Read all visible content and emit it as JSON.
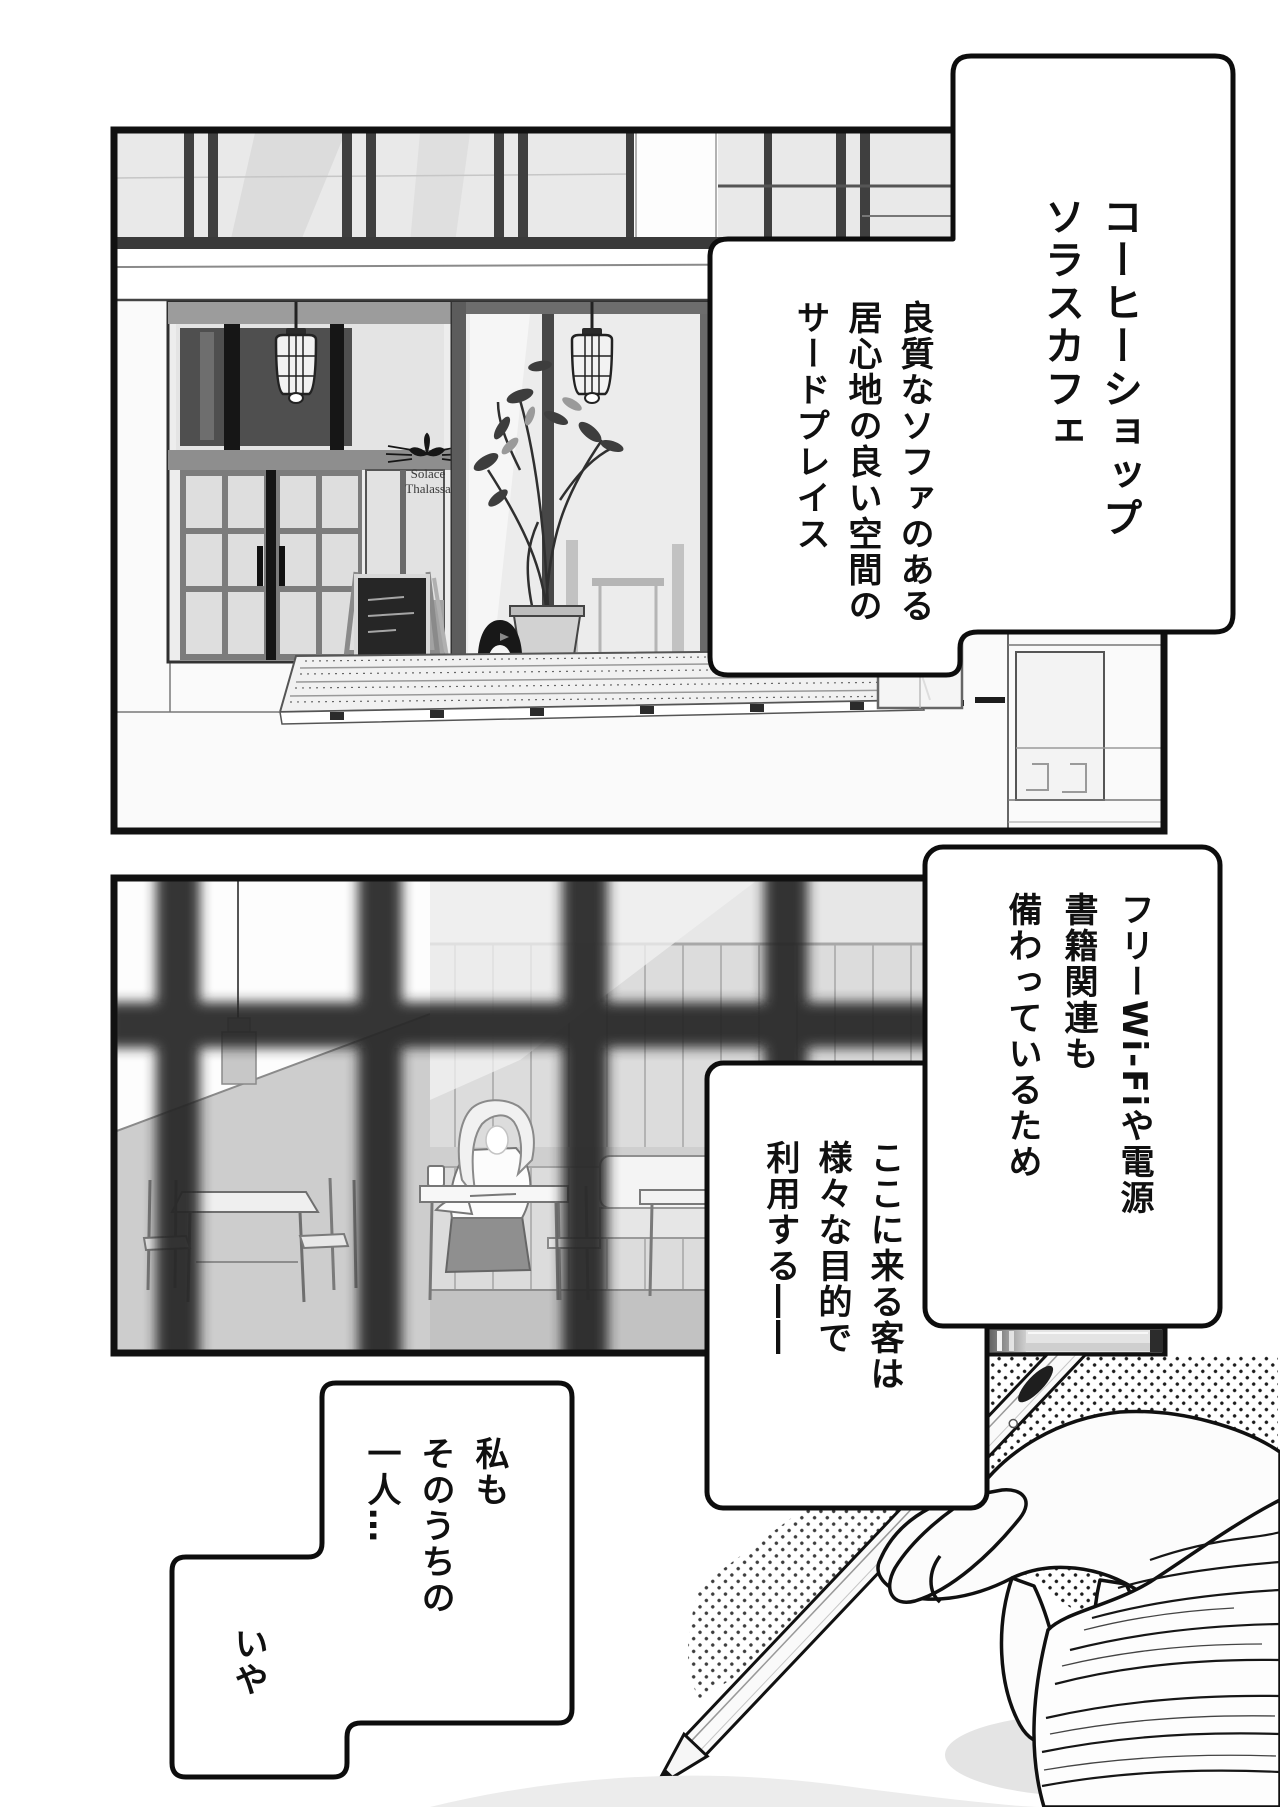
{
  "page": {
    "type": "manga page",
    "background": "#ffffff",
    "ink_color": "#111111",
    "panel1_description": "cafe storefront exterior with double doors, display window, plant, chalkboard and deck",
    "panel2_description": "cafe interior seen through an out-of-focus window grid, woman writing at a table",
    "bottom_art_description": "hand in chunky knit sleeve holding a pencil beside a tablet, halftone dots"
  },
  "bubbles": {
    "cafe_name": {
      "lines": [
        "コーヒーショップ",
        "ソラスカフェ"
      ]
    },
    "space": {
      "lines": [
        "良質なソファのある",
        "居心地の良い空間の",
        "サードプレイス"
      ]
    },
    "amenities": {
      "lines": [
        "フリーWi-Fiや電源",
        "書籍関連も",
        "備わっているため"
      ]
    },
    "customers": {
      "lines": [
        "ここに来る客は",
        "様々な目的で",
        "利用する――"
      ]
    },
    "monologue_main": {
      "lines": [
        "私も",
        "そのうちの",
        "一人…"
      ]
    },
    "monologue_tail": {
      "lines": [
        "いや"
      ]
    }
  },
  "storefront_sign": {
    "name_line1": "Solace",
    "name_line2": "Thalassa"
  },
  "icons": {
    "sign_logo": "sprout-with-whiskers",
    "lamps": "caged-pendant-lamp",
    "statue": "penguin-statue"
  },
  "colors": {
    "glass": "#e9e9e9",
    "frame_dark": "#4f4f4f",
    "wood_wall": "#dcdcdc",
    "blur_grid": "#262626",
    "wall_gray": "#cdcdcd"
  }
}
